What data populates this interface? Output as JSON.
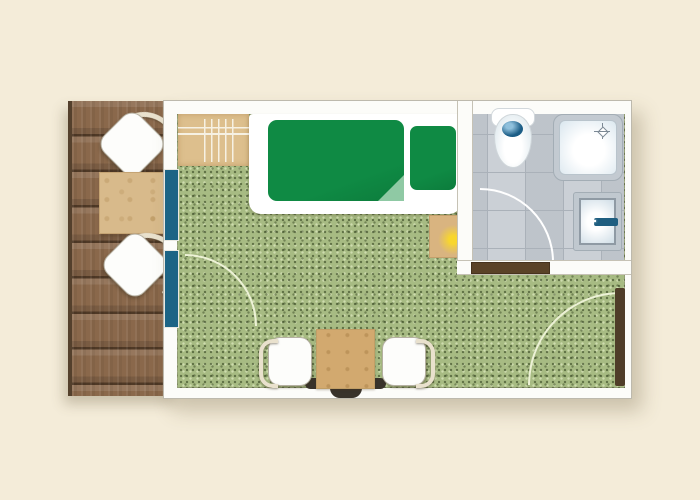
{
  "floor_plan": {
    "kind": "hotel-room-floor-plan",
    "rooms": [
      {
        "id": "deck",
        "floor": "wood-planks",
        "furniture": [
          "lounge-chair",
          "side-table",
          "lounge-chair"
        ]
      },
      {
        "id": "bedroom",
        "floor": "green-carpet",
        "furniture": [
          "luggage-rack",
          "single-bed",
          "duvet",
          "pillow",
          "nightstand-with-lamp",
          "dining-table",
          "dining-chair",
          "dining-chair",
          "bench"
        ]
      },
      {
        "id": "bathroom",
        "floor": "gray-tile",
        "furniture": [
          "toilet",
          "shower",
          "sink-with-faucet"
        ]
      }
    ],
    "doors": [
      {
        "id": "sliding-door",
        "type": "sliding",
        "location": "deck-to-bedroom"
      },
      {
        "id": "entry-door",
        "type": "hinged",
        "location": "bedroom-right-wall"
      },
      {
        "id": "bathroom-door",
        "type": "hinged-with-threshold",
        "location": "bathroom-bottom-wall"
      }
    ]
  },
  "colors": {
    "background": "#f4ecd9",
    "wall_fill": "#fcfcf9",
    "wall_edge": "#bdb9ad",
    "deck_wood": "#8a684b",
    "deck_table_wood": "#d8ba8b",
    "carpet": "#a7bb83",
    "sliding_door_blue": "#1c6485",
    "bed_green": "#0f8a44",
    "bed_fold_green": "#8fc9a4",
    "rack_wood": "#ddbf8d",
    "nightstand_wood": "#d9b480",
    "lamp_yellow": "#f7d92e",
    "tile": "#c7ccd2",
    "tile_line": "#aab1b9",
    "toilet_blue": "#1c5d86",
    "faucet_blue": "#1f5e80",
    "entry_door_brown": "#4f3d28",
    "sill_brown": "#5a4227",
    "arc_line": "#edf2d6",
    "chair_arm": "#e9e1cd",
    "bench_dark": "#39332b",
    "dining_table_wood": "#d2a96f"
  }
}
